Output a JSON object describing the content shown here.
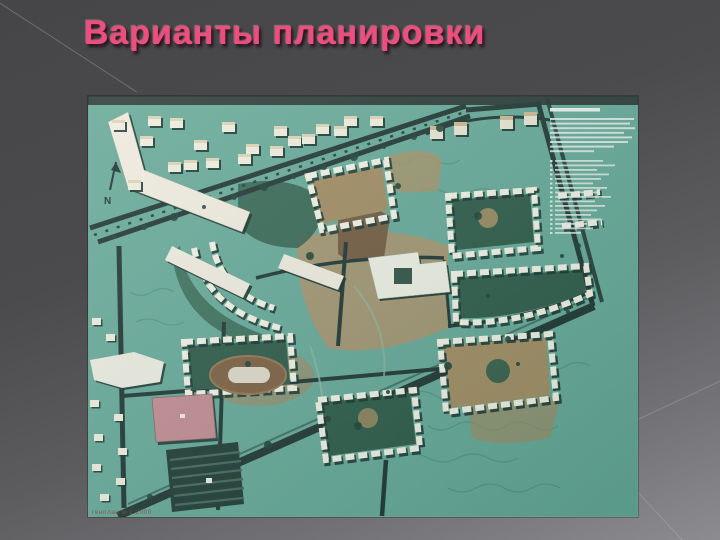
{
  "slide": {
    "title": "Варианты планировки",
    "title_color": "#ee4d7d",
    "background_top": "#464648",
    "background_bottom": "#8c8c90"
  },
  "map": {
    "caption": "генплан м 1:2000",
    "north_label": "N",
    "colors": {
      "ground_teal": "#66a897",
      "road_dark": "#1f3531",
      "building_white": "#efecdd",
      "building_shadow": "#16302a",
      "courtyard_green": "#2d5947",
      "park_green": "#2f5c49",
      "ground_tan": "#ab9168",
      "ground_brown": "#6e5238",
      "stadium_brown": "#7d5f41",
      "pink_building": "#c18b90",
      "parking_dark": "#203b34",
      "contour_line": "#4e8e80",
      "legend_text": "#e9f0ea",
      "caption_text": "#86453c"
    },
    "legend": {
      "paragraph_line_widths": [
        84,
        80,
        85,
        74,
        82,
        78,
        64,
        44
      ],
      "list_line_widths": [
        48,
        60,
        42,
        54,
        46,
        38,
        52,
        44,
        56,
        40,
        50,
        42,
        36,
        46,
        32,
        38,
        26
      ]
    }
  }
}
